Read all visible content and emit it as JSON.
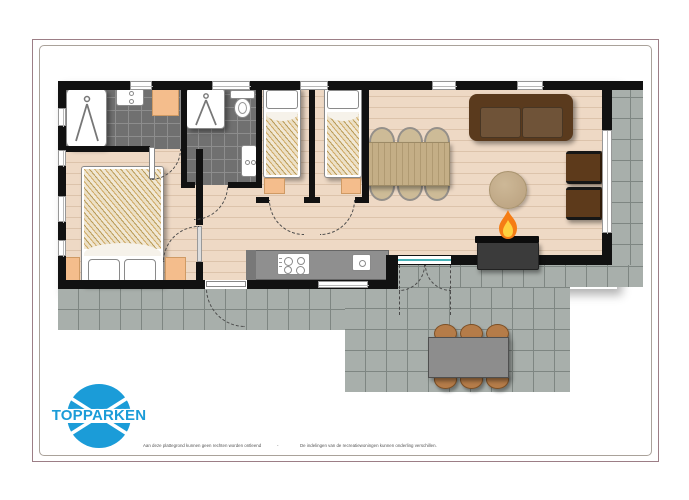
{
  "page": {
    "background": "#ffffff"
  },
  "frame": {
    "outer_color": "#9c7e86",
    "inner_color": "#aaa29a"
  },
  "logo": {
    "text": "TOPPARKEN",
    "color": "#1b9cd8"
  },
  "footer": {
    "left": "Aan deze plattegrond kunnen geen rechten worden ontleend",
    "separator": "-",
    "right": "De indelingen van de recreatiewoningen kunnen onderling verschillen."
  },
  "palette": {
    "wall": "#111111",
    "floor": "#eed9c5",
    "floor_line": "#dcc3ab",
    "bathroom_tile": "#707070",
    "terrace_tile": "#a8afab",
    "accent_orange": "#f4bd8c",
    "sofa_brown": "#5a3a1d",
    "armchair_brown": "#5d3a1b",
    "wood": "#c4ae86",
    "outdoor_chair": "#b57c49",
    "fire_orange": "#f57d15",
    "fire_yellow": "#ffd23f",
    "slider_teal": "#45b0b5"
  },
  "icons": [
    "shower-icon",
    "sink-icon",
    "toilet-icon",
    "washing-machine-icon",
    "wardrobe-icon",
    "double-bed-icon",
    "single-bed-icon",
    "nightstand-icon",
    "pillow-icon",
    "dining-table-icon",
    "dining-chair-icon",
    "sofa-icon",
    "armchair-icon",
    "rug-icon",
    "fireplace-icon",
    "flame-icon",
    "stove-icon",
    "kitchen-sink-icon",
    "outdoor-table-icon",
    "outdoor-chair-icon",
    "door-swing-icon",
    "window-icon",
    "sliding-door-icon",
    "logo-globe-icon"
  ]
}
